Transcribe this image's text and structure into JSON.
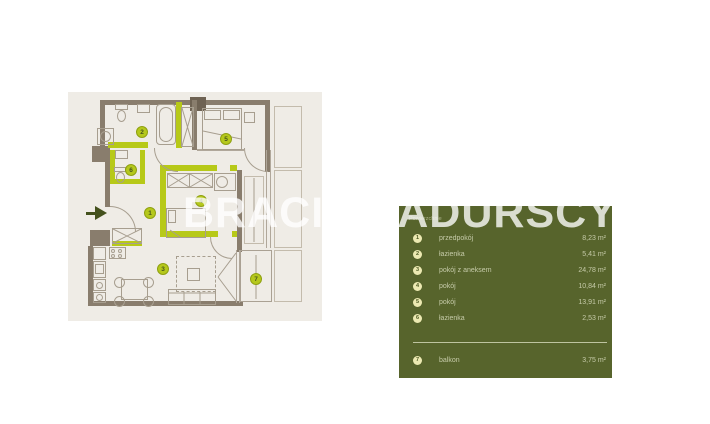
{
  "watermark": "BRACIA SADURSCY",
  "plan": {
    "badges": [
      "1",
      "2",
      "3",
      "4",
      "5",
      "6",
      "7"
    ]
  },
  "legend": {
    "header": "Powierzchnie",
    "rows": [
      {
        "num": "1",
        "label": "przedpokój",
        "area": "8,23 m²"
      },
      {
        "num": "2",
        "label": "łazienka",
        "area": "5,41 m²"
      },
      {
        "num": "3",
        "label": "pokój z aneksem",
        "area": "24,78 m²"
      },
      {
        "num": "4",
        "label": "pokój",
        "area": "10,84 m²"
      },
      {
        "num": "5",
        "label": "pokój",
        "area": "13,91 m²"
      },
      {
        "num": "6",
        "label": "łazienka",
        "area": "2,53 m²"
      }
    ],
    "footer_row": {
      "num": "7",
      "label": "balkon",
      "area": "3,75 m²"
    }
  },
  "colors": {
    "accent_lime": "#b7c918",
    "wall_brown": "#897d6d",
    "panel_olive": "#57642c",
    "badge_cream": "#ece9b2",
    "plan_background": "#efece6"
  }
}
